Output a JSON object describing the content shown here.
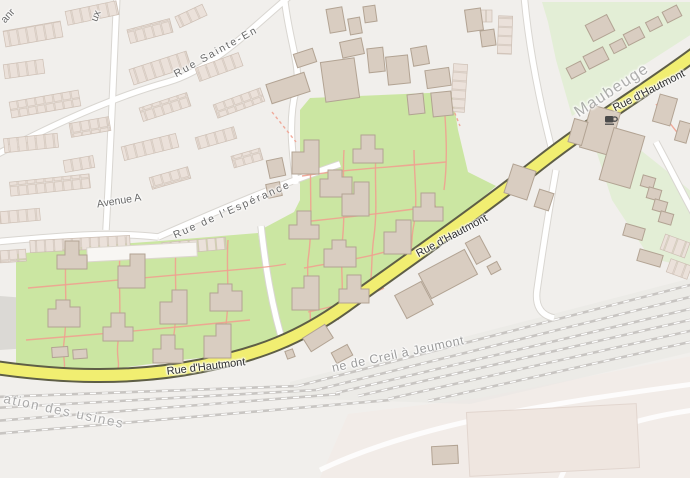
{
  "streets": {
    "partial_top_left": "anr",
    "partial_top": "ux",
    "rue_sainte": "Rue Sainte-En",
    "avenue_a": "Avenue A",
    "rue_esperance": "Rue de l'Espérance",
    "rue_hautmont": "Rue d'Hautmont"
  },
  "places": {
    "city": "Maubeuge"
  },
  "railways": {
    "line": "ne de Creil à Jeumont",
    "branch": "ation des usines"
  },
  "icons": {
    "cafe": "cafe-icon"
  },
  "colors": {
    "background": "#F1EFEC",
    "grass": "#CBE6A2",
    "pale_green": "#E3EED6",
    "building_fill": "#D9CDC1",
    "building_stroke": "#B2A393",
    "terrace_fill": "#EBE1DA",
    "terrace_stroke": "#D3C5BA",
    "road_fill": "#FFFFFF",
    "road_casing": "#D9D6D1",
    "secondary_fill": "#F1EE71",
    "secondary_casing": "#5E5E46",
    "path": "#F0A190",
    "railway": "#C8C5C2",
    "railway_dash": "#FFFFFF",
    "industrial": "#F2ECE8",
    "industrial_building": "#EFE6E0",
    "gray_area": "#DBD9D5",
    "street_label": "#686868",
    "road_label": "#2E2E2E",
    "railway_label": "#9B9B9B",
    "place_label": "#9E9E9E"
  }
}
